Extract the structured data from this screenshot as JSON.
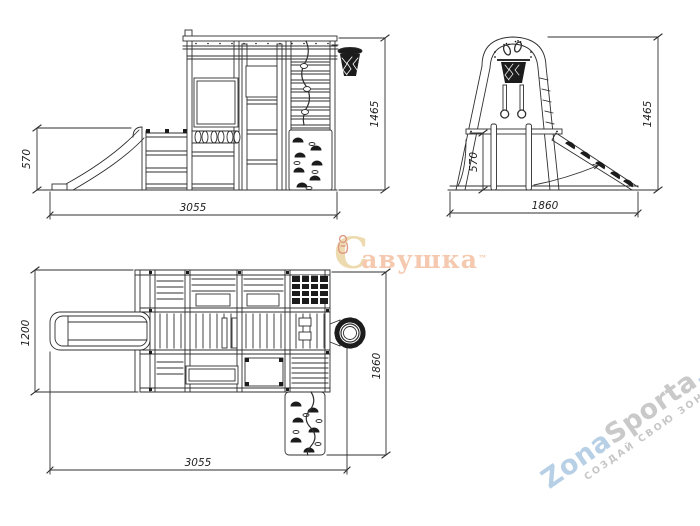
{
  "drawing": {
    "front": {
      "dim_left": "570",
      "dim_bottom": "3055",
      "dim_right": "1465"
    },
    "side": {
      "dim_inner": "570",
      "dim_bottom": "1860",
      "dim_right": "1465"
    },
    "plan": {
      "dim_left": "1200",
      "dim_bottom": "3055",
      "dim_right": "1860"
    }
  },
  "watermarks": {
    "savushka": {
      "initial": "С",
      "rest": "авушка",
      "trademark": "™"
    },
    "zonasporta": {
      "zona": "Zona",
      "sporta": "Sporta",
      "domain": ".com",
      "tagline": "СОЗДАЙ СВОЮ ЗОНУ СПОРТА"
    }
  },
  "colors": {
    "line": "#2f2f2f",
    "dark_fill": "#1c1c1c",
    "savushka_gold": "#ead5a2",
    "savushka_coral": "#f4c0a2",
    "zona_blue": "#b7d0e6",
    "zona_gray": "#c9c9c9"
  }
}
